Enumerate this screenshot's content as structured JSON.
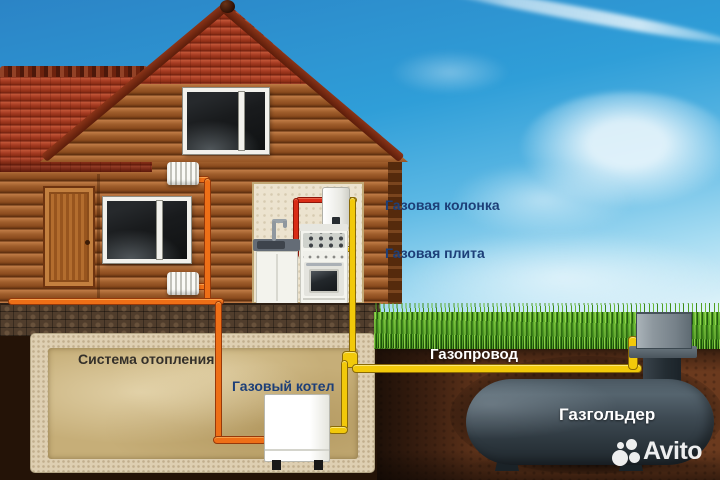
{
  "illustration": {
    "labels": {
      "gas_water_heater": "Газовая колонка",
      "gas_stove": "Газовая плита",
      "heating_system": "Система отопления",
      "gas_boiler": "Газовый котел",
      "gas_pipeline": "Газопровод",
      "gas_holder": "Газгольдер"
    },
    "watermark": {
      "brand": "Avito"
    },
    "colors": {
      "gas_pipe_yellow": "#f2c90a",
      "heating_pipe_orange": "#ee6f17",
      "hot_water_pipe_red": "#d92c16",
      "label_navy": "#1d3f78",
      "label_charcoal": "#34302a",
      "label_white": "#ffffff",
      "tank_slate": "#3d4a53",
      "roof_red": "#a63c22",
      "log_brown": "#a05e2c",
      "grass_green": "#52a426",
      "soil_brown": "#6b3a1e",
      "sky_blue": "#2f9ed8"
    }
  }
}
